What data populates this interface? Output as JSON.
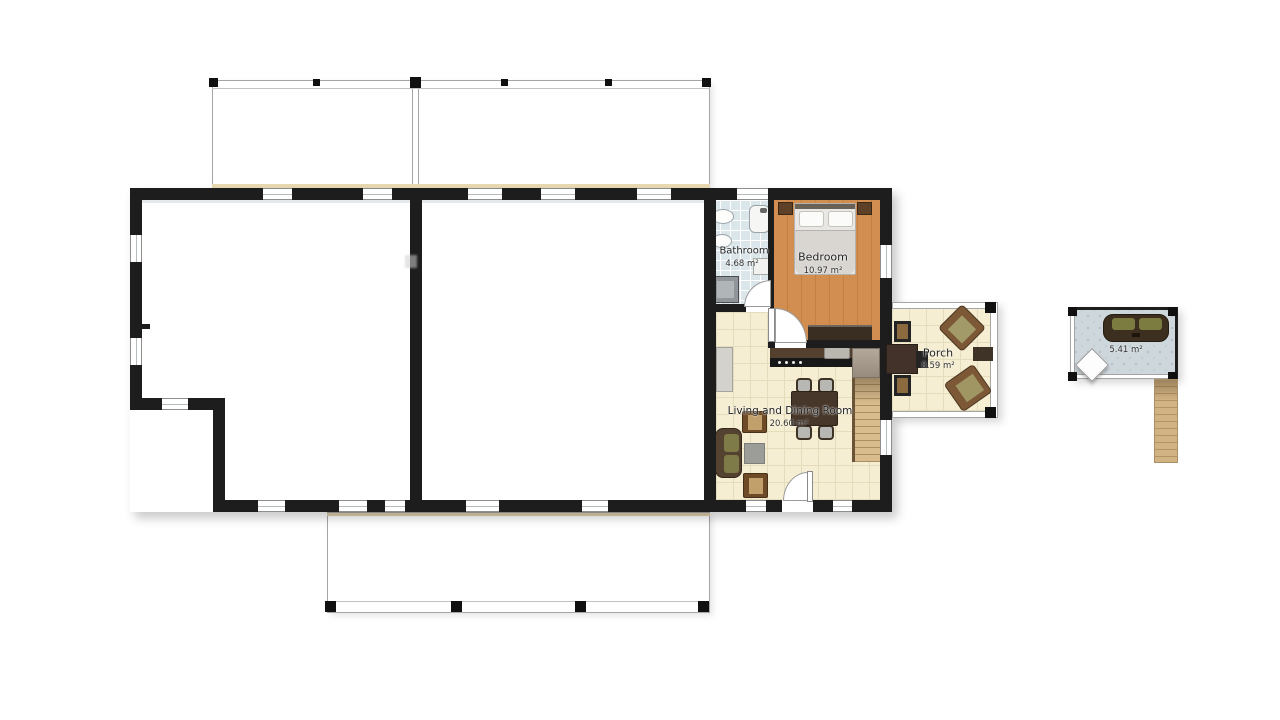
{
  "rooms": [
    {
      "name": "Bathroom",
      "area": "4.68 m²"
    },
    {
      "name": "Bedroom",
      "area": "10.97 m²"
    },
    {
      "name": "Living and Dining Room",
      "area": "20.60 m²"
    },
    {
      "name": "Porch",
      "area": "8.59 m²"
    },
    {
      "area": "5.41 m²"
    }
  ],
  "colors": {
    "wall": "#1d1d1d",
    "floor_living": "#f5eed3",
    "floor_bedroom_wood": "#d0894b",
    "floor_bathroom_tile": "#dbe6eb",
    "floor_deck_pattern": "#ced7dc",
    "stairs_wood": "#d8bc8e",
    "furniture_dark_brown": "#47372b",
    "cushion_olive": "#7f7b48",
    "counter_front_black": "#181818"
  }
}
